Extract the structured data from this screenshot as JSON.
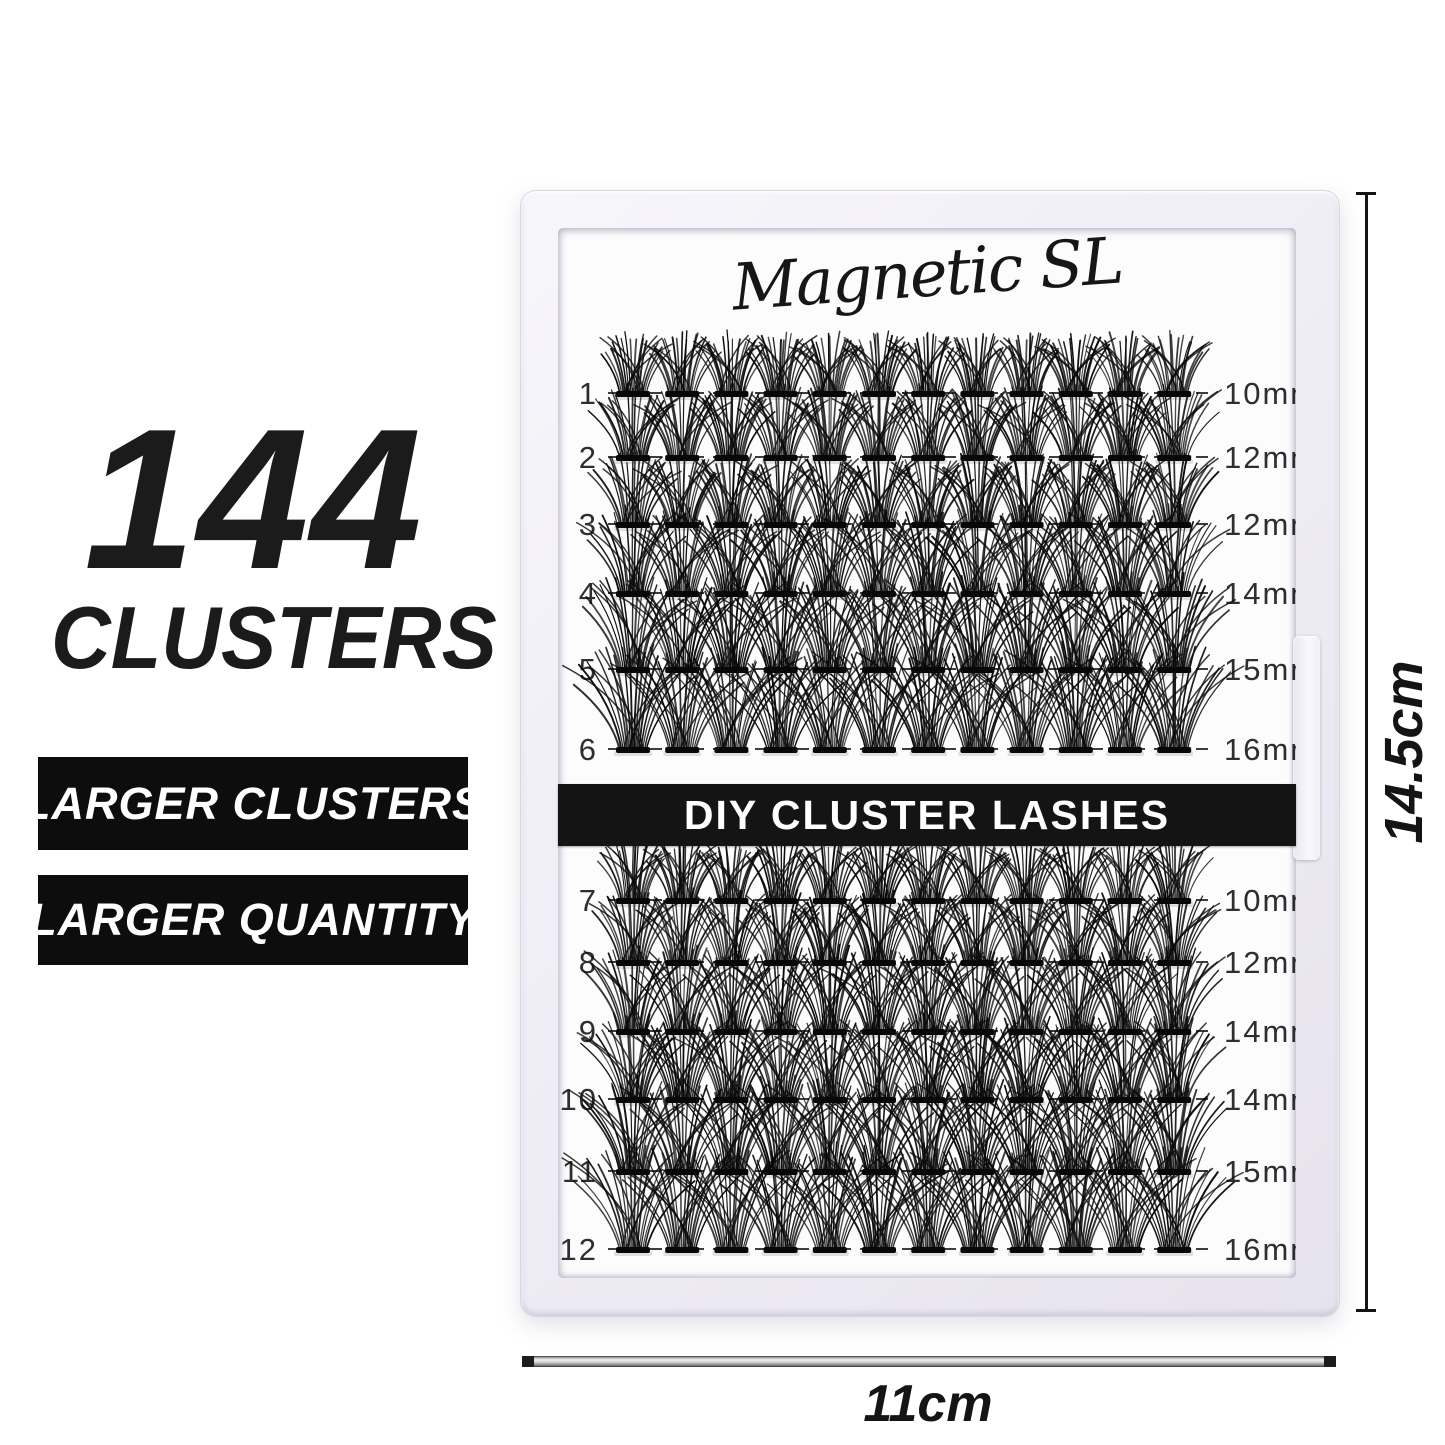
{
  "left_panel": {
    "headline_number": "144",
    "headline_word": "CLUSTERS",
    "badges": [
      "LARGER CLUSTERS",
      "LARGER QUANTITY"
    ]
  },
  "tray": {
    "brand": "Magnetic SL",
    "banner": "DIY CLUSTER LASHES",
    "clusters_per_row": 12,
    "rows": [
      {
        "num": "1",
        "size": "10mm",
        "mm": 10
      },
      {
        "num": "2",
        "size": "12mm",
        "mm": 12
      },
      {
        "num": "3",
        "size": "12mm",
        "mm": 12
      },
      {
        "num": "4",
        "size": "14mm",
        "mm": 14
      },
      {
        "num": "5",
        "size": "15mm",
        "mm": 15
      },
      {
        "num": "6",
        "size": "16mm",
        "mm": 16
      },
      {
        "num": "7",
        "size": "10mm",
        "mm": 10
      },
      {
        "num": "8",
        "size": "12mm",
        "mm": 12
      },
      {
        "num": "9",
        "size": "14mm",
        "mm": 14
      },
      {
        "num": "10",
        "size": "14mm",
        "mm": 14
      },
      {
        "num": "11",
        "size": "15mm",
        "mm": 15
      },
      {
        "num": "12",
        "size": "16mm",
        "mm": 16
      }
    ]
  },
  "dimensions": {
    "height_label": "14.5cm",
    "width_label": "11cm"
  },
  "colors": {
    "banner_bg": "#141414",
    "badge_bg": "#0d0d0d",
    "lash": "#0a0a0a",
    "dash": "#3c3c3c",
    "text": "#1b1b1b"
  }
}
